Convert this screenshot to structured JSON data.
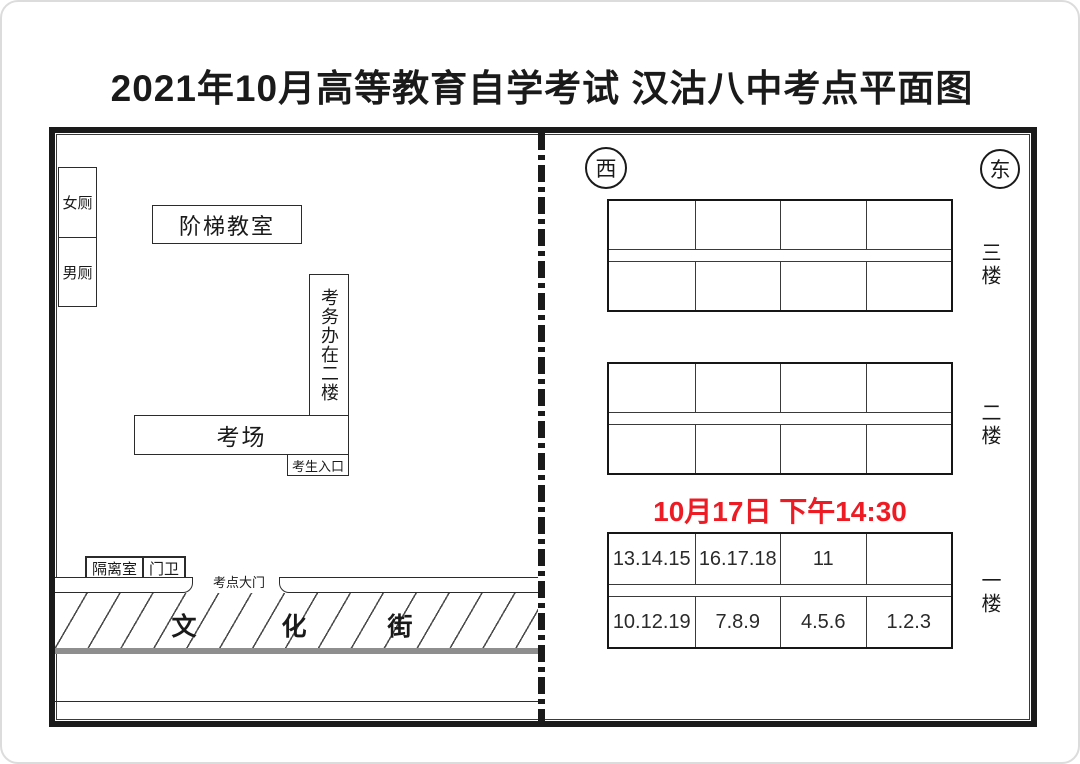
{
  "page": {
    "title": "2021年10月高等教育自学考试 汉沽八中考点平面图"
  },
  "colors": {
    "ink": "#1a1a1a",
    "accent_red": "#ed1c24",
    "street_gray": "#8e8e8e"
  },
  "campus": {
    "women_toilet": "女厕",
    "men_toilet": "男厕",
    "lecture_hall": "阶梯教室",
    "exam_office_note": "考务办在二楼",
    "exam_room": "考场",
    "candidate_entrance": "考生入口",
    "isolation_room": "隔离室",
    "guard_room": "门卫",
    "main_gate_label": "考点大门",
    "street_name_chars": [
      "文",
      "化",
      "街"
    ]
  },
  "building": {
    "compass_west": "西",
    "compass_east": "东",
    "session_label": "10月17日  下午14:30",
    "floors": [
      {
        "label": "三楼",
        "top_cells": [
          "",
          "",
          "",
          ""
        ],
        "bottom_cells": [
          "",
          "",
          "",
          ""
        ]
      },
      {
        "label": "二楼",
        "top_cells": [
          "",
          "",
          "",
          ""
        ],
        "bottom_cells": [
          "",
          "",
          "",
          ""
        ]
      },
      {
        "label": "一楼",
        "top_cells": [
          "13.14.15",
          "16.17.18",
          "11",
          ""
        ],
        "bottom_cells": [
          "10.12.19",
          "7.8.9",
          "4.5.6",
          "1.2.3"
        ]
      }
    ]
  }
}
